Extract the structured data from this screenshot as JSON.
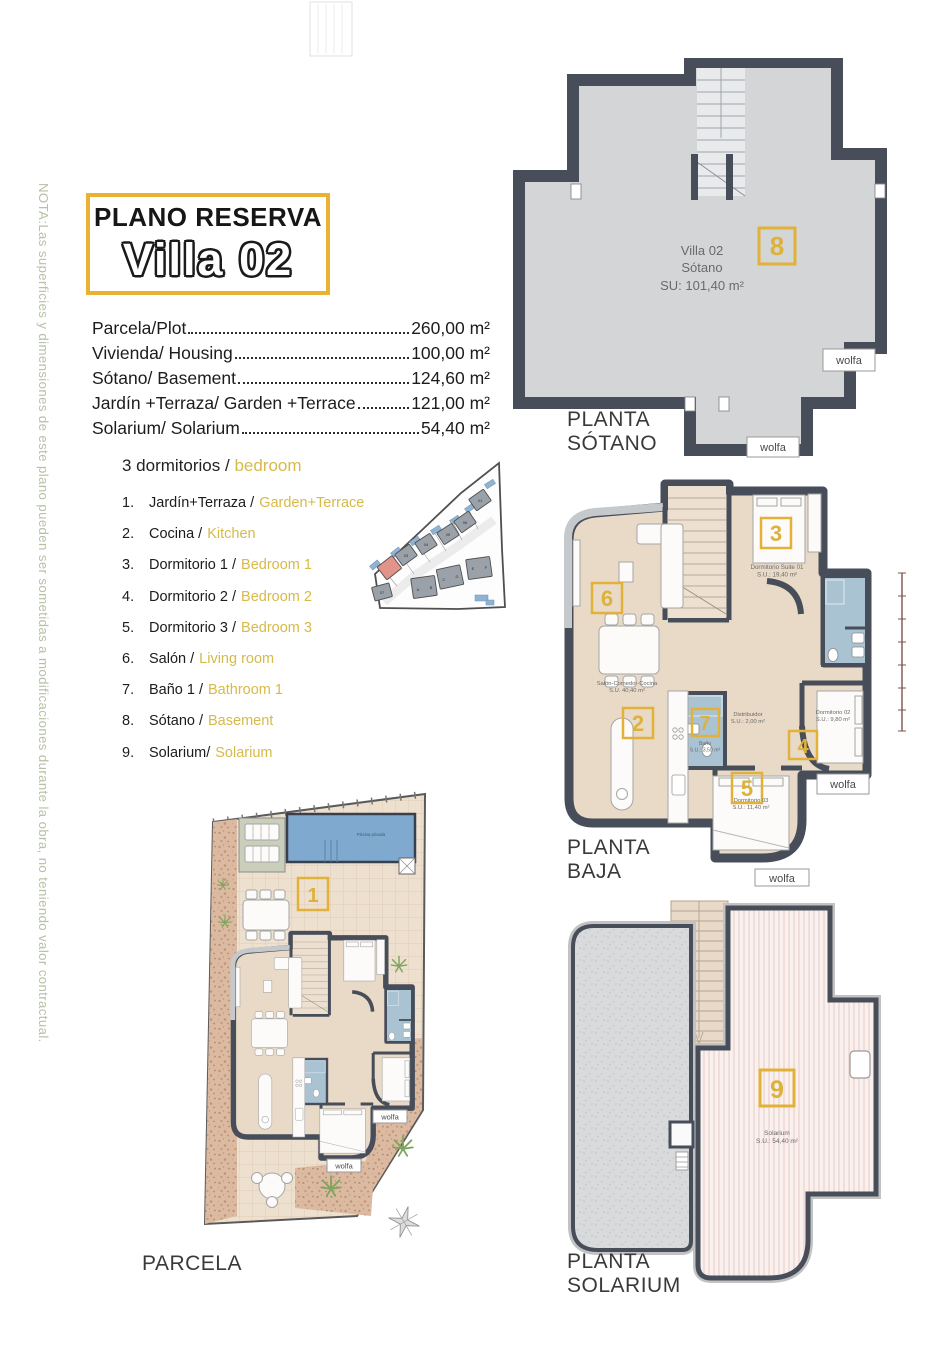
{
  "note": "NOTA:Las superficies y dimensiones de este plano pueden ser sometidas a modificaciones durante la obra, no teniendo valor contractual.",
  "title": {
    "kicker": "PLANO RESERVA",
    "name": "Villa 02"
  },
  "colors": {
    "accent_yellow": "#e2b138",
    "list_yellow": "#d6ba4a",
    "wall": "#474d59",
    "bath_blue": "#a9c3d3",
    "pool_blue": "#7fa9cf",
    "note_green": "#b6c1a6"
  },
  "areas": [
    {
      "label": "Parcela/Plot",
      "value": "260,00 m²"
    },
    {
      "label": "Vivienda/ Housing",
      "value": "100,00 m²"
    },
    {
      "label": "Sótano/ Basement",
      "value": "124,60 m²"
    },
    {
      "label": "Jardín +Terraza/ Garden +Terrace",
      "value": "121,00 m²"
    },
    {
      "label": "Solarium/ Solarium",
      "value": "54,40 m²"
    }
  ],
  "rooms": {
    "heading_es": "3 dormitorios /",
    "heading_en": "bedroom",
    "items": [
      {
        "num": "1.",
        "es": "Jardín+Terraza /",
        "en": "Garden+Terrace"
      },
      {
        "num": "2.",
        "es": "Cocina /",
        "en": "Kitchen"
      },
      {
        "num": "3.",
        "es": "Dormitorio 1 /",
        "en": "Bedroom 1"
      },
      {
        "num": "4.",
        "es": "Dormitorio 2 /",
        "en": "Bedroom 2"
      },
      {
        "num": "5.",
        "es": "Dormitorio 3 /",
        "en": "Bedroom 3"
      },
      {
        "num": "6.",
        "es": "Salón /",
        "en": "Living room"
      },
      {
        "num": "7.",
        "es": "Baño 1 /",
        "en": "Bathroom 1"
      },
      {
        "num": "8.",
        "es": "Sótano /",
        "en": "Basement"
      },
      {
        "num": "9.",
        "es": "Solarium/",
        "en": "Solarium"
      }
    ]
  },
  "stamp": "wolfa",
  "plan_sotano": {
    "caption1": "PLANTA",
    "caption2": "SÓTANO",
    "num": "8",
    "name": "Villa 02",
    "room": "Sótano",
    "area": "SU: 101,40 m²"
  },
  "plan_baja": {
    "caption1": "PLANTA",
    "caption2": "BAJA",
    "num_salon": "6",
    "num_suite": "3",
    "num_cocina": "2",
    "num_bano": "7",
    "num_dorm2": "4",
    "num_dorm3": "5",
    "suite_name": "Dormitorio Suite 01",
    "suite_area": "S.U.: 19,40 m²",
    "salon_name": "Salón-Comedor-Cocina",
    "salon_area": "S.U. 40,40 m²",
    "distrib_name": "Distribuidor",
    "distrib_area": "S.U.: 2,00 m²",
    "bano_name": "Baño",
    "bano_area": "S.U.: 3,50 m²",
    "dorm2_name": "Dormitorio 02",
    "dorm2_area": "S.U.: 9,80 m²",
    "dorm3_name": "Dormitorio 03",
    "dorm3_area": "S.U.: 11,40 m²"
  },
  "plan_parcela": {
    "caption": "PARCELA",
    "num": "1",
    "pool_label": "Piscina privada"
  },
  "plan_solarium": {
    "caption1": "PLANTA",
    "caption2": "SOLARIUM",
    "num": "9",
    "name": "Solarium",
    "area": "S.U.: 54,40 m²"
  },
  "site_map": {
    "labels": [
      "01",
      "06",
      "05",
      "04",
      "03",
      "07",
      "A",
      "B",
      "C",
      "D",
      "E",
      "F"
    ]
  }
}
